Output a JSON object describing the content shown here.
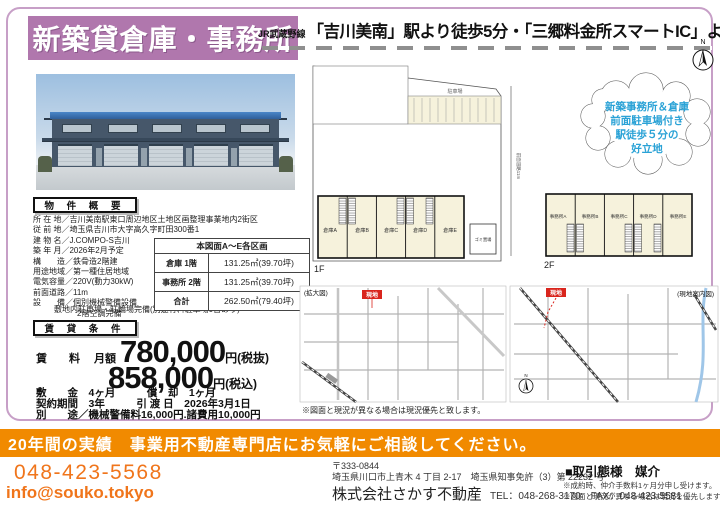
{
  "colors": {
    "banner_purple": "#b077ad",
    "frame_purple": "#c79fc7",
    "accent_orange": "#f18a00",
    "text_orange": "#f0751b",
    "site_badge_red": "#d9251d",
    "bubble_blue": "#2aa2d6",
    "plan_cream": "#f6f2dc"
  },
  "header": {
    "title_banner": "新築貸倉庫・事務所",
    "route_prefix": "JR武蔵野線",
    "route_main": "「吉川美南」駅より徒歩5分・「三郷料金所スマートIC」より約2.6km"
  },
  "property": {
    "section_title": "物 件 概 要",
    "details": [
      "所 在 地／吉川美南駅東口周辺地区土地区画整理事業地内2街区",
      "従 前 地／埼玉県吉川市大字高久字町田300番1",
      "建 物 名／J.COMPO-S吉川",
      "築 年 月／2026年2月予定",
      "構　　造／鉄骨造2階建",
      "用途地域／第一種住居地域",
      "電気容量／220V(動力30kW)",
      "前面道路／11m",
      "設　　備／個別機械警備設備",
      "2階空調完備"
    ],
    "note": "敷地内駐車場・駐輪場完備(別途有料駐車場0台あり)",
    "table": {
      "header": "本図面A〜E各区画",
      "rows": [
        {
          "label": "倉庫 1階",
          "value": "131.25㎡(39.70坪)"
        },
        {
          "label": "事務所 2階",
          "value": "131.25㎡(39.70坪)"
        },
        {
          "label": "合計",
          "value": "262.50㎡(79.40坪)"
        }
      ]
    }
  },
  "lease": {
    "section_title": "賃 貸 条 件",
    "rent_label": "賃　　料",
    "monthly_label": "月額",
    "price_excl": "780,000",
    "unit_excl": "円(税抜)",
    "price_incl": "858,000",
    "unit_incl": "円(税込)",
    "deposit_line": "敷　　金　4ヶ月　　　償　却　1ヶ月",
    "term_line": "契約期間　3年　　　引 渡 日　2026年3月1日",
    "extra_line": "別　　途／機械警備料16,000円.諸費用10,000円"
  },
  "siteplan": {
    "floor1_label": "1F",
    "floor2_label": "2F",
    "parking_label": "駐車場",
    "trash_label": "ゴミ置場",
    "road_label": "前面道路11m",
    "units_1f": [
      "倉庫A",
      "倉庫B",
      "倉庫C",
      "倉庫D",
      "倉庫E"
    ],
    "units_2f": [
      "事務所A",
      "事務所B",
      "事務所C",
      "事務所D",
      "事務所E"
    ],
    "compass_n": "N"
  },
  "bubble": {
    "line1": "新築事務所＆倉庫",
    "line2": "前面駐車場付き",
    "line3": "駅徒歩５分の",
    "line4": "好立地"
  },
  "maps": {
    "left_label": "(拡大図)",
    "right_label": "(現地案内図)",
    "site_badge": "現地",
    "compass_n": "N",
    "note": "※図面と現況が異なる場合は現況優先と致します。"
  },
  "footer": {
    "banner": "20年間の実績　事業用不動産専門店にお気軽にご相談してください。",
    "phone": "048-423-5568",
    "email": "info@souko.tokyo",
    "postal": "〒333-0844",
    "address": "埼玉県川口市上青木 4 丁目 2-17　埼玉県知事免許（3）第 22232 号",
    "company": "株式会社さかす不動産",
    "tel_fax": "TEL：048-268-3170　FAX：048-423-5581",
    "deal_type": "■取引態様　媒介",
    "note1": "※成約時、仲介手数料1ヶ月分申し受けます。",
    "note2": "※図面と現況が異なる場合は現況を優先します。"
  }
}
